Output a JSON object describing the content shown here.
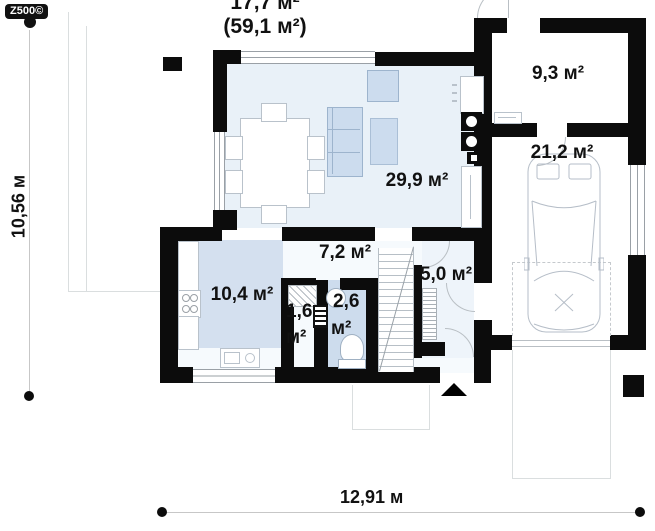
{
  "logo": "Z500©",
  "summary": {
    "area_line1": "17,7 м²",
    "area_line2": "(59,1 м²)"
  },
  "dimensions": {
    "height_label": "10,56 м",
    "width_label": "12,91 м"
  },
  "rooms": {
    "living": "29,9 м²",
    "storage": "9,3 м²",
    "garage": "21,2 м²",
    "hall": "7,2 м²",
    "kitchen": "10,4 м²",
    "pantry_value": "1,6",
    "pantry_unit": "м²",
    "wc_value": "2,6",
    "wc_unit": "м²",
    "entry": "5,0 м²"
  },
  "colors": {
    "wall": "#0c0c0c",
    "living_floor": "#e9f1f8",
    "kitchen_patch": "#d4e0ef",
    "wc_floor": "#cddced",
    "furniture_blue": "#ccdcee"
  }
}
